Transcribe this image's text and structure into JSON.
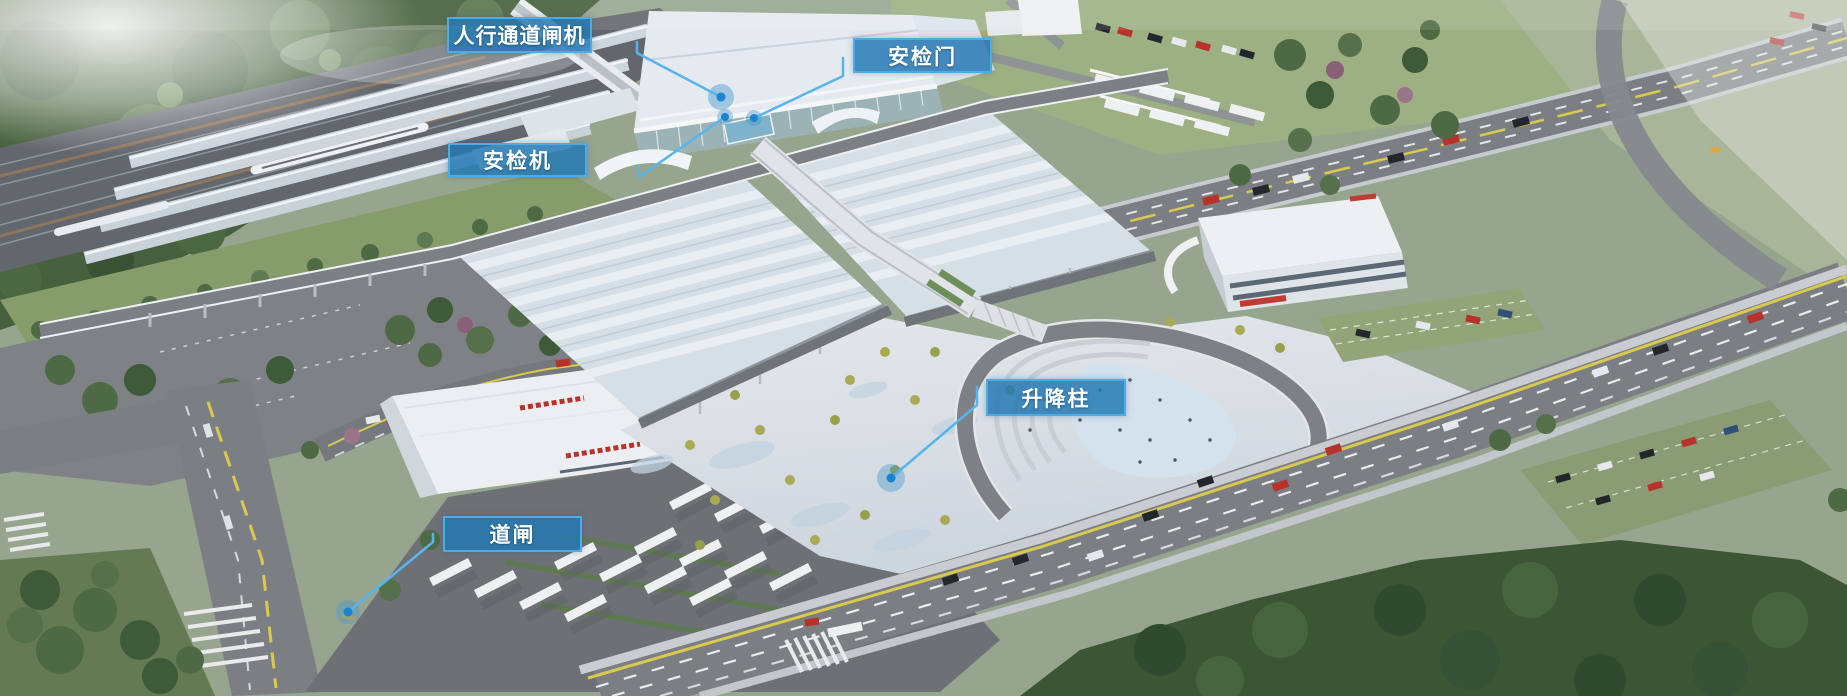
{
  "callouts": {
    "items": [
      {
        "id": "pedestrian-channel-gate",
        "label": "人行通道闸机"
      },
      {
        "id": "security-check-door",
        "label": "安检门"
      },
      {
        "id": "security-check-machine",
        "label": "安检机"
      },
      {
        "id": "lifting-bollard",
        "label": "升降柱"
      },
      {
        "id": "road-barrier-gate",
        "label": "道闸"
      }
    ],
    "style": {
      "label_background": "#2478b4",
      "label_border": "#4fabe2",
      "label_text_color": "#ffffff",
      "leader_line_color": "#58b4ec",
      "anchor_dot_color": "#1b84d0"
    }
  }
}
